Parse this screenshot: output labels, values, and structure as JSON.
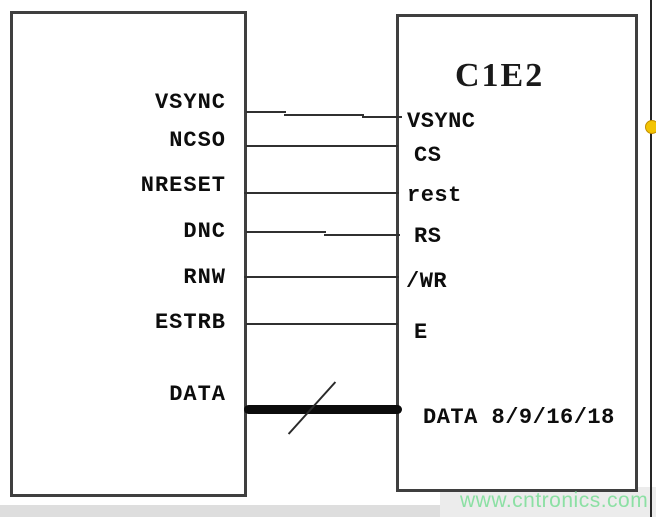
{
  "left_box": {
    "pins": [
      {
        "name": "VSYNC"
      },
      {
        "name": "NCSO"
      },
      {
        "name": "NRESET"
      },
      {
        "name": "DNC"
      },
      {
        "name": "RNW"
      },
      {
        "name": "ESTRB"
      },
      {
        "name": "DATA"
      }
    ]
  },
  "right_box": {
    "title": "C1E2",
    "pins": [
      {
        "name": "VSYNC"
      },
      {
        "name": "CS"
      },
      {
        "name": "rest"
      },
      {
        "name": "RS"
      },
      {
        "name": "/WR"
      },
      {
        "name": "E"
      },
      {
        "name": "DATA 8/9/16/18"
      }
    ]
  },
  "connections": [
    {
      "from": "VSYNC",
      "to": "VSYNC",
      "type": "wire"
    },
    {
      "from": "NCSO",
      "to": "CS",
      "type": "wire"
    },
    {
      "from": "NRESET",
      "to": "rest",
      "type": "wire"
    },
    {
      "from": "DNC",
      "to": "RS",
      "type": "wire"
    },
    {
      "from": "RNW",
      "to": "/WR",
      "type": "wire"
    },
    {
      "from": "ESTRB",
      "to": "E",
      "type": "wire"
    },
    {
      "from": "DATA",
      "to": "DATA 8/9/16/18",
      "type": "bus"
    }
  ],
  "watermark": "www.cntronics.com",
  "colors": {
    "wire": "#303030",
    "bus": "#0c0c0c",
    "box_border": "#3f3f3f",
    "text": "#0d0d0d",
    "watermark": "#8ce0a4",
    "marker_dot": "#f3c404"
  }
}
